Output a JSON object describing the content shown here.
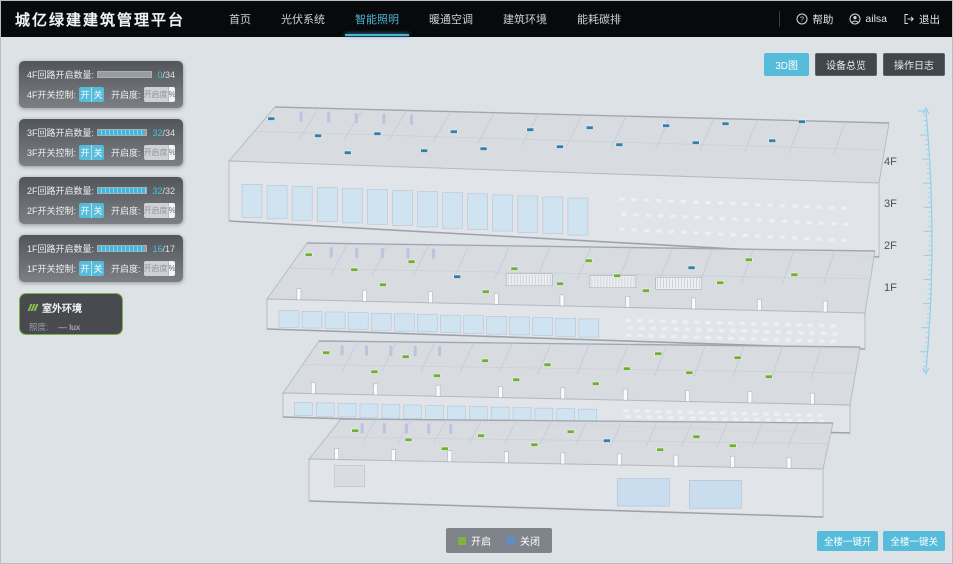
{
  "header": {
    "title": "城亿绿建建筑管理平台",
    "nav": [
      {
        "label": "首页",
        "active": false
      },
      {
        "label": "光伏系统",
        "active": false
      },
      {
        "label": "智能照明",
        "active": true
      },
      {
        "label": "暖通空调",
        "active": false
      },
      {
        "label": "建筑环境",
        "active": false
      },
      {
        "label": "能耗碳排",
        "active": false
      }
    ],
    "user": {
      "help_label": "帮助",
      "username": "ailsa",
      "logout_label": "退出"
    }
  },
  "view_buttons": [
    {
      "label": "3D图",
      "active": true
    },
    {
      "label": "设备总览",
      "active": false
    },
    {
      "label": "操作日志",
      "active": false
    }
  ],
  "floor_panels": [
    {
      "floor": "4F",
      "count_label": "4F回路开启数量:",
      "on": "0",
      "total_suffix": "/34",
      "progress_pct": 0,
      "switch_label": "4F开关控制:",
      "on_btn": "开",
      "off_btn": "关",
      "dim_label": "开启度:",
      "dim_placeholder": "开启度",
      "percent_label": "%"
    },
    {
      "floor": "3F",
      "count_label": "3F回路开启数量:",
      "on": "32",
      "total_suffix": "/34",
      "progress_pct": 94,
      "switch_label": "3F开关控制:",
      "on_btn": "开",
      "off_btn": "关",
      "dim_label": "开启度:",
      "dim_placeholder": "开启度",
      "percent_label": "%"
    },
    {
      "floor": "2F",
      "count_label": "2F回路开启数量:",
      "on": "32",
      "total_suffix": "/32",
      "progress_pct": 100,
      "switch_label": "2F开关控制:",
      "on_btn": "开",
      "off_btn": "关",
      "dim_label": "开启度:",
      "dim_placeholder": "开启度",
      "percent_label": "%"
    },
    {
      "floor": "1F",
      "count_label": "1F回路开启数量:",
      "on": "16",
      "total_suffix": "/17",
      "progress_pct": 94,
      "switch_label": "1F开关控制:",
      "on_btn": "开",
      "off_btn": "关",
      "dim_label": "开启度:",
      "dim_placeholder": "开启度",
      "percent_label": "%"
    }
  ],
  "outdoor_panel": {
    "title": "室外环境",
    "metric_label": "照度:",
    "metric_value": "— lux"
  },
  "floor_scale": {
    "labels": [
      "4F",
      "3F",
      "2F",
      "1F"
    ]
  },
  "legend": {
    "on_label": "开启",
    "off_label": "关闭",
    "on_color": "#7cb342",
    "off_color": "#5b8fd0"
  },
  "bulk_buttons": [
    {
      "label": "全楼一键开"
    },
    {
      "label": "全楼一键关"
    }
  ],
  "colors": {
    "accent": "#4db3d4",
    "button_blue": "#56bcd9",
    "light_on": "#6fae2e",
    "light_off": "#2e7ea9",
    "ruler_blue": "#8fd0e8"
  }
}
